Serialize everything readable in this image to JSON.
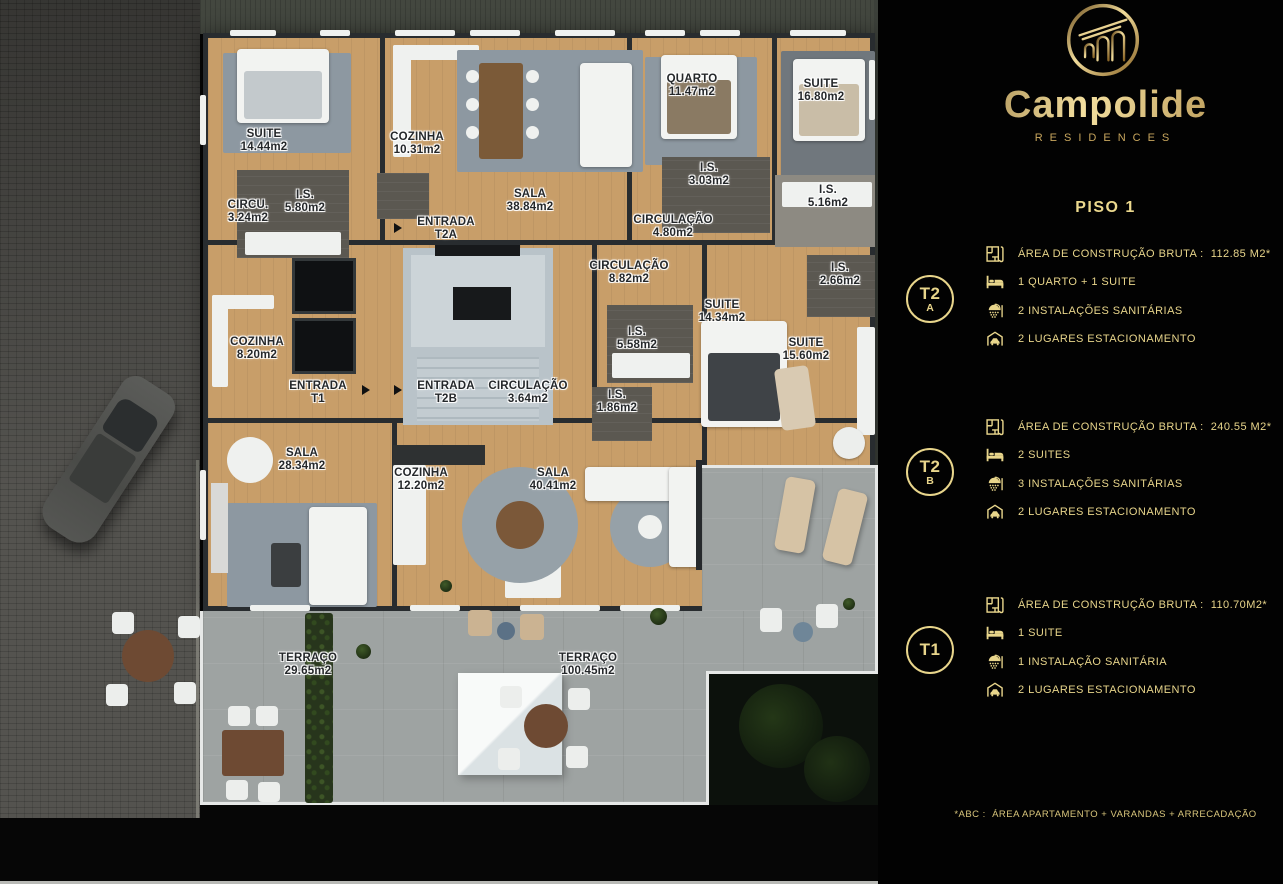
{
  "brand": {
    "wordmark": "Campolide",
    "subtitle": "RESIDENCES"
  },
  "panel": {
    "floor_title": "PISO 1",
    "units": [
      {
        "id": "T2A",
        "badge_line1": "T2",
        "badge_line2": "A",
        "area": "ÁREA DE CONSTRUÇÃO BRUTA :  112.85 M2*",
        "bedrooms": "1 QUARTO + 1 SUITE",
        "bathrooms": "2 INSTALAÇÕES SANITÁRIAS",
        "parking": "2 LUGARES ESTACIONAMENTO"
      },
      {
        "id": "T2B",
        "badge_line1": "T2",
        "badge_line2": "B",
        "area": "ÁREA DE CONSTRUÇÃO BRUTA :  240.55 M2*",
        "bedrooms": "2 SUITES",
        "bathrooms": "3 INSTALAÇÕES SANITÁRIAS",
        "parking": "2 LUGARES ESTACIONAMENTO"
      },
      {
        "id": "T1",
        "badge_line1": "T1",
        "badge_line2": "",
        "area": "ÁREA DE CONSTRUÇÃO BRUTA :  110.70M2*",
        "bedrooms": "1 SUITE",
        "bathrooms": "1 INSTALAÇÃO SANITÁRIA",
        "parking": "2 LUGARES ESTACIONAMENTO"
      }
    ],
    "footnote": "*ABC :  ÁREA APARTAMENTO + VARANDAS + ARRECADAÇÃO"
  },
  "floorplan": {
    "rooms": [
      {
        "name": "SUITE",
        "area": "14.44m2",
        "x": 264,
        "y": 141
      },
      {
        "name": "COZINHA",
        "area": "10.31m2",
        "x": 417,
        "y": 144
      },
      {
        "name": "QUARTO",
        "area": "11.47m2",
        "x": 692,
        "y": 86
      },
      {
        "name": "SUITE",
        "area": "16.80m2",
        "x": 821,
        "y": 91
      },
      {
        "name": "CIRCU.",
        "area": "3.24m2",
        "x": 248,
        "y": 212
      },
      {
        "name": "I.S.",
        "area": "5.80m2",
        "x": 305,
        "y": 202
      },
      {
        "name": "SALA",
        "area": "38.84m2",
        "x": 530,
        "y": 201
      },
      {
        "name": "I.S.",
        "area": "3.03m2",
        "x": 709,
        "y": 175
      },
      {
        "name": "I.S.",
        "area": "5.16m2",
        "x": 828,
        "y": 197
      },
      {
        "name": "ENTRADA",
        "area": "T2A",
        "x": 446,
        "y": 229
      },
      {
        "name": "CIRCULAÇÃO",
        "area": "4.80m2",
        "x": 673,
        "y": 227
      },
      {
        "name": "CIRCULAÇÃO",
        "area": "8.82m2",
        "x": 629,
        "y": 273
      },
      {
        "name": "I.S.",
        "area": "2.66m2",
        "x": 840,
        "y": 275
      },
      {
        "name": "SUITE",
        "area": "14.34m2",
        "x": 722,
        "y": 312
      },
      {
        "name": "I.S.",
        "area": "5.58m2",
        "x": 637,
        "y": 339
      },
      {
        "name": "SUITE",
        "area": "15.60m2",
        "x": 806,
        "y": 350
      },
      {
        "name": "COZINHA",
        "area": "8.20m2",
        "x": 257,
        "y": 349
      },
      {
        "name": "ENTRADA",
        "area": "T1",
        "x": 318,
        "y": 393
      },
      {
        "name": "ENTRADA",
        "area": "T2B",
        "x": 446,
        "y": 393
      },
      {
        "name": "CIRCULAÇÃO",
        "area": "3.64m2",
        "x": 528,
        "y": 393
      },
      {
        "name": "I.S.",
        "area": "1.86m2",
        "x": 617,
        "y": 402
      },
      {
        "name": "SALA",
        "area": "28.34m2",
        "x": 302,
        "y": 460
      },
      {
        "name": "COZINHA",
        "area": "12.20m2",
        "x": 421,
        "y": 480
      },
      {
        "name": "SALA",
        "area": "40.41m2",
        "x": 553,
        "y": 480
      },
      {
        "name": "TERRAÇO",
        "area": "29.65m2",
        "x": 308,
        "y": 665
      },
      {
        "name": "TERRAÇO",
        "area": "100.45m2",
        "x": 588,
        "y": 665
      }
    ]
  },
  "colors": {
    "gold": "#e8d58b",
    "panel_bg": "#020202",
    "wood": "#c89e69",
    "wall": "#282c2f",
    "terrace": "#9ea3a2"
  }
}
